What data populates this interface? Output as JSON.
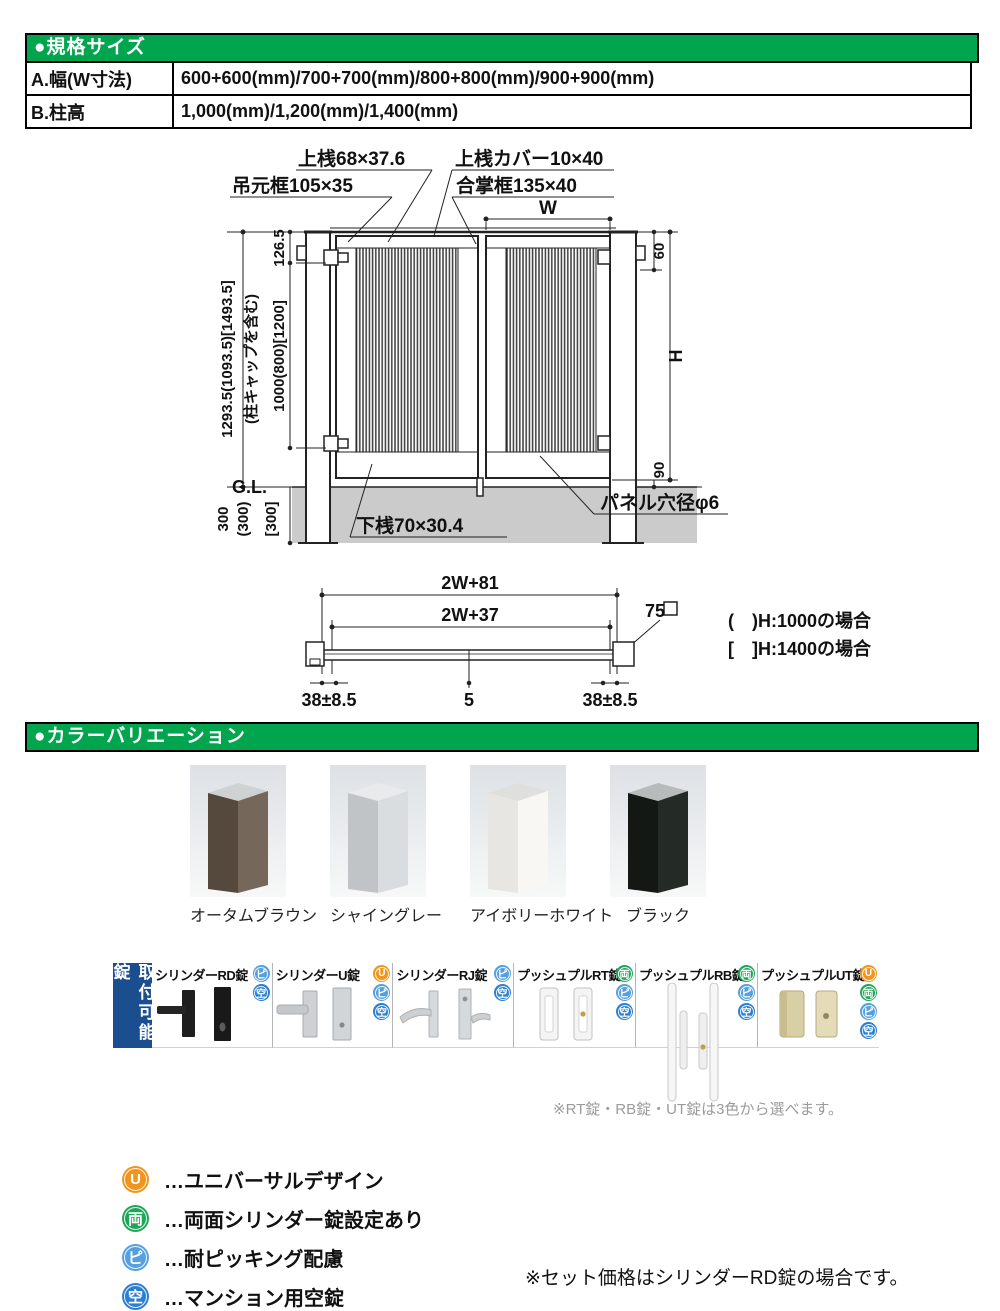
{
  "spec_table": {
    "header": "●規格サイズ",
    "rows": [
      {
        "label": "A.幅(W寸法)",
        "value": "600+600(mm)/700+700(mm)/800+800(mm)/900+900(mm)"
      },
      {
        "label": "B.柱高",
        "value": "1,000(mm)/1,200(mm)/1,400(mm)"
      }
    ]
  },
  "diagram": {
    "labels": {
      "top_rail": "上桟68×37.6",
      "top_cover": "上桟カバー10×40",
      "hanging_stile": "吊元框105×35",
      "meeting_stile": "合掌框135×40",
      "w": "W",
      "total_height": "1293.5(1093.5)[1493.5]",
      "cap_note": "(柱キャップを含む)",
      "d126": "126.5",
      "d1000": "1000(800)[1200]",
      "gl": "G.L.",
      "d300": "300",
      "d300p": "(300)",
      "d300b": "[300]",
      "d60": "60",
      "dH": "H",
      "d90": "90",
      "bottom_rail": "下桟70×30.4",
      "panel_hole": "パネル穴径φ6",
      "p2w81": "2W+81",
      "p2w37": "2W+37",
      "p75": "75",
      "p38l": "38±8.5",
      "p5": "5",
      "p38r": "38±8.5",
      "noteA": "(　)H:1000の場合",
      "noteB": "[　]H:1400の場合"
    }
  },
  "colors_section": {
    "header": "●カラーバリエーション",
    "accent_green": "#00a54e",
    "swatches": [
      {
        "name": "オータムブラウン",
        "face": "#75675a",
        "side": "#55483c",
        "top": "#cfd2d3"
      },
      {
        "name": "シャイングレー",
        "face": "#dadddf",
        "side": "#c0c4c7",
        "top": "#e8eaeb"
      },
      {
        "name": "アイボリーホワイト",
        "face": "#f8f7f4",
        "side": "#e7e6e2",
        "top": "#dfe0de"
      },
      {
        "name": "ブラック",
        "face": "#242b26",
        "side": "#141814",
        "top": "#b7bbbb"
      }
    ]
  },
  "locks_section": {
    "side_label": "取付可能錠",
    "side_label_color": "#1b4e8e",
    "locks": [
      {
        "name": "シリンダーRD錠",
        "icons": [
          "pi",
          "ku"
        ]
      },
      {
        "name": "シリンダーU錠",
        "icons": [
          "u",
          "pi",
          "ku"
        ]
      },
      {
        "name": "シリンダーRJ錠",
        "icons": [
          "pi",
          "ku"
        ]
      },
      {
        "name": "プッシュプルRT錠",
        "icons": [
          "ryo",
          "pi",
          "ku"
        ]
      },
      {
        "name": "プッシュプルRB錠",
        "icons": [
          "ryo",
          "pi",
          "ku"
        ]
      },
      {
        "name": "プッシュプルUT錠",
        "icons": [
          "u",
          "ryo",
          "pi",
          "ku"
        ]
      }
    ],
    "note": "※RT錠・RB錠・UT錠は3色から選べます。"
  },
  "icon_defs": {
    "u": {
      "glyph": "U",
      "color": "#f0961e"
    },
    "ryo": {
      "glyph": "両",
      "color": "#1ea75a"
    },
    "pi": {
      "glyph": "ピ",
      "color": "#56a0dd"
    },
    "ku": {
      "glyph": "空",
      "color": "#2b7fd2"
    }
  },
  "legend": {
    "items": [
      {
        "icon": "u",
        "label": "…ユニバーサルデザイン"
      },
      {
        "icon": "ryo",
        "label": "…両面シリンダー錠設定あり"
      },
      {
        "icon": "pi",
        "label": "…耐ピッキング配慮"
      },
      {
        "icon": "ku",
        "label": "…マンション用空錠"
      }
    ],
    "footnote": "※セット価格はシリンダーRD錠の場合です。"
  }
}
